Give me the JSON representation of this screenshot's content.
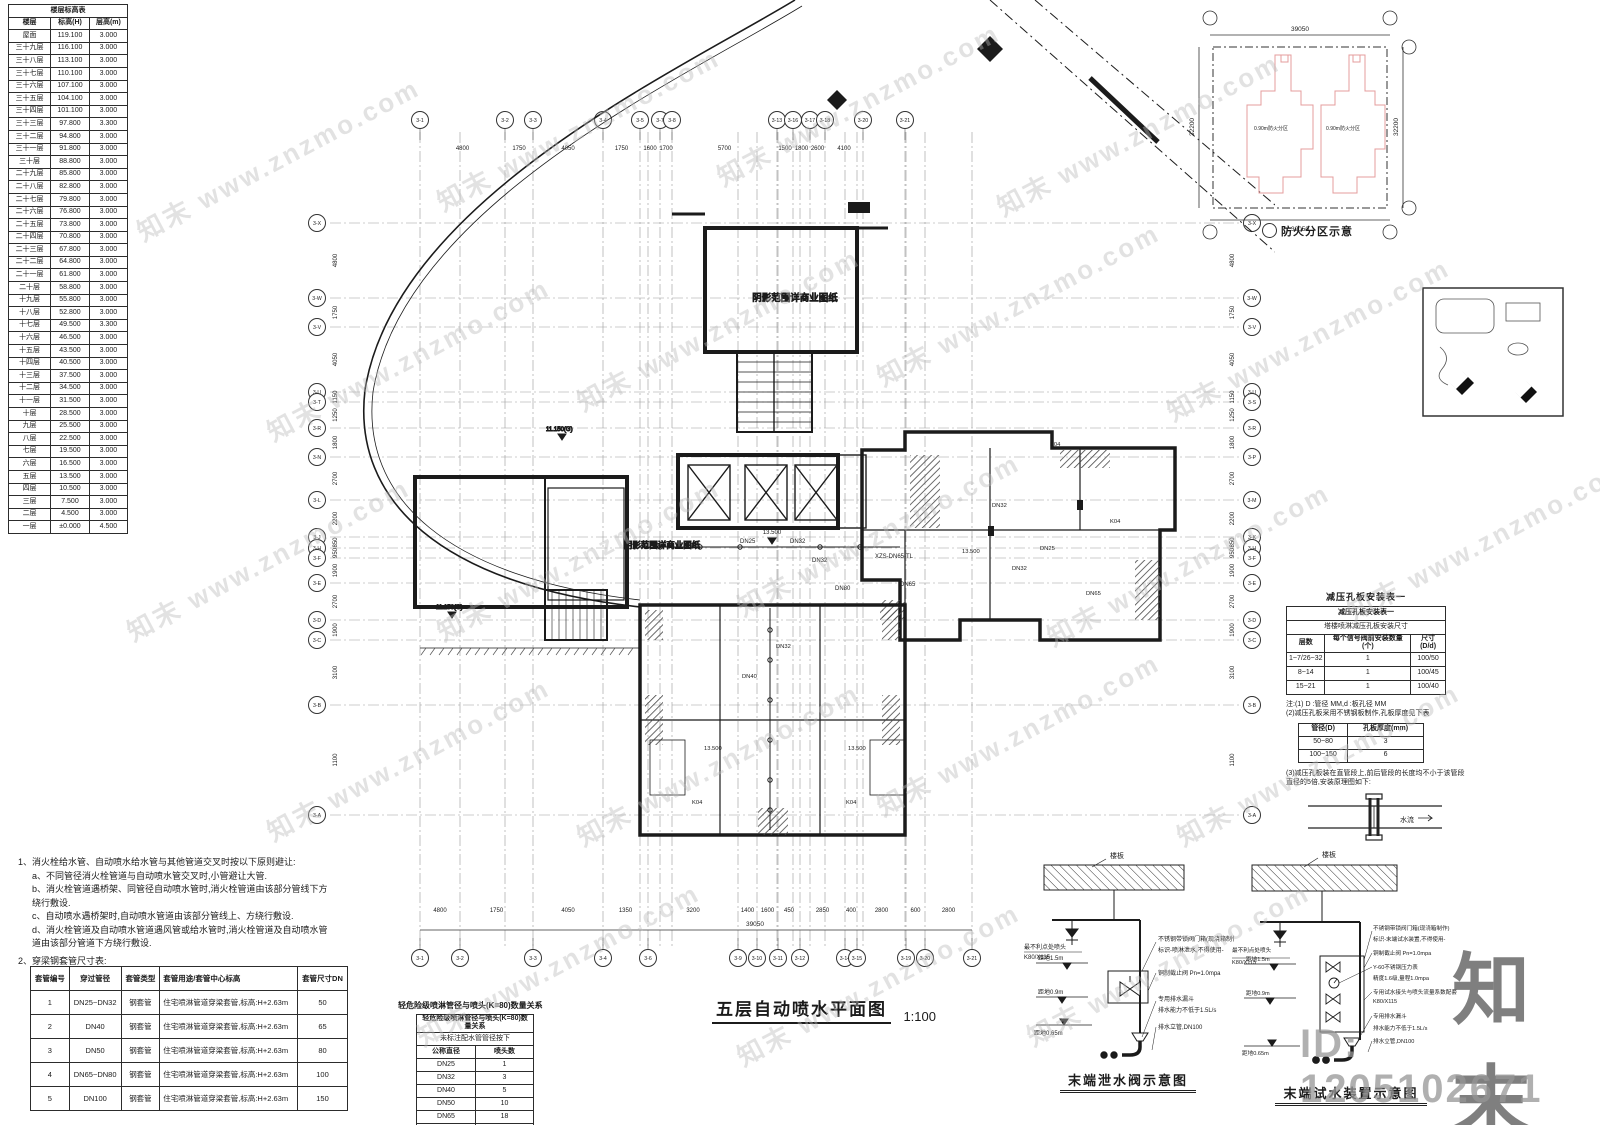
{
  "watermark": {
    "text": "知末 www.znzmo.com",
    "brand": "知末",
    "id_text": "ID: 1205102671"
  },
  "floor_table": {
    "title": "楼层标高表",
    "columns": [
      "楼层",
      "标高(H)",
      "层高(m)"
    ],
    "rows": [
      [
        "屋面",
        "119.100",
        "3.000"
      ],
      [
        "三十九层",
        "116.100",
        "3.000"
      ],
      [
        "三十八层",
        "113.100",
        "3.000"
      ],
      [
        "三十七层",
        "110.100",
        "3.000"
      ],
      [
        "三十六层",
        "107.100",
        "3.000"
      ],
      [
        "三十五层",
        "104.100",
        "3.000"
      ],
      [
        "三十四层",
        "101.100",
        "3.000"
      ],
      [
        "三十三层",
        "97.800",
        "3.300"
      ],
      [
        "三十二层",
        "94.800",
        "3.000"
      ],
      [
        "三十一层",
        "91.800",
        "3.000"
      ],
      [
        "三十层",
        "88.800",
        "3.000"
      ],
      [
        "二十九层",
        "85.800",
        "3.000"
      ],
      [
        "二十八层",
        "82.800",
        "3.000"
      ],
      [
        "二十七层",
        "79.800",
        "3.000"
      ],
      [
        "二十六层",
        "76.800",
        "3.000"
      ],
      [
        "二十五层",
        "73.800",
        "3.000"
      ],
      [
        "二十四层",
        "70.800",
        "3.000"
      ],
      [
        "二十三层",
        "67.800",
        "3.000"
      ],
      [
        "二十二层",
        "64.800",
        "3.000"
      ],
      [
        "二十一层",
        "61.800",
        "3.000"
      ],
      [
        "二十层",
        "58.800",
        "3.000"
      ],
      [
        "十九层",
        "55.800",
        "3.000"
      ],
      [
        "十八层",
        "52.800",
        "3.000"
      ],
      [
        "十七层",
        "49.500",
        "3.300"
      ],
      [
        "十六层",
        "46.500",
        "3.000"
      ],
      [
        "十五层",
        "43.500",
        "3.000"
      ],
      [
        "十四层",
        "40.500",
        "3.000"
      ],
      [
        "十三层",
        "37.500",
        "3.000"
      ],
      [
        "十二层",
        "34.500",
        "3.000"
      ],
      [
        "十一层",
        "31.500",
        "3.000"
      ],
      [
        "十层",
        "28.500",
        "3.000"
      ],
      [
        "九层",
        "25.500",
        "3.000"
      ],
      [
        "八层",
        "22.500",
        "3.000"
      ],
      [
        "七层",
        "19.500",
        "3.000"
      ],
      [
        "六层",
        "16.500",
        "3.000"
      ],
      [
        "五层",
        "13.500",
        "3.000"
      ],
      [
        "四层",
        "10.500",
        "3.000"
      ],
      [
        "三层",
        "7.500",
        "3.000"
      ],
      [
        "二层",
        "4.500",
        "3.000"
      ],
      [
        "一层",
        "±0.000",
        "4.500"
      ]
    ]
  },
  "notes": {
    "heading": "1、消火栓给水管、自动喷水给水管与其他管道交叉时按以下原则避让:",
    "items": [
      "a、不同管径消火栓管道与自动喷水管交叉时,小管避让大管.",
      "b、消火栓管道遇桥架、同管径自动喷水管时,消火栓管道由该部分管线下方绕行敷设.",
      "c、自动喷水遇桥架时,自动喷水管道由该部分管线上、方绕行敷设.",
      "d、消火栓管道及自动喷水管道遇风管或给水管时,消火栓管道及自动喷水管道由该部分管道下方绕行敷设."
    ],
    "table_heading": "2、穿梁钢套管尺寸表:"
  },
  "sleeve_table": {
    "columns": [
      "套管编号",
      "穿过管径",
      "套管类型",
      "套管用途/套管中心标高",
      "套管尺寸DN"
    ],
    "rows": [
      [
        "1",
        "DN25~DN32",
        "钢套管",
        "住宅喷淋管道穿梁套管,标高:H+2.63m",
        "50"
      ],
      [
        "2",
        "DN40",
        "钢套管",
        "住宅喷淋管道穿梁套管,标高:H+2.63m",
        "65"
      ],
      [
        "3",
        "DN50",
        "钢套管",
        "住宅喷淋管道穿梁套管,标高:H+2.63m",
        "80"
      ],
      [
        "4",
        "DN65~DN80",
        "钢套管",
        "住宅喷淋管道穿梁套管,标高:H+2.63m",
        "100"
      ],
      [
        "5",
        "DN100",
        "钢套管",
        "住宅喷淋管道穿梁套管,标高:H+2.63m",
        "150"
      ]
    ]
  },
  "head_table": {
    "title": "轻危险级喷淋管径与喷头(K=80)数量关系",
    "subtitle": "未标注配水管管径按下",
    "columns": [
      "公称直径",
      "喷头数"
    ],
    "rows": [
      [
        "DN25",
        "1"
      ],
      [
        "DN32",
        "3"
      ],
      [
        "DN40",
        "5"
      ],
      [
        "DN50",
        "10"
      ],
      [
        "DN65",
        "18"
      ],
      [
        "DN80",
        "48"
      ],
      [
        "DN100",
        "49个以上"
      ]
    ]
  },
  "orifice": {
    "title": "减压孔板安装表一",
    "subtitle": "塔楼喷淋减压孔板安装尺寸",
    "columns": [
      "层数",
      "每个信号阀前安装数量(个)",
      "尺寸(D/d)"
    ],
    "rows": [
      [
        "1~7/26~32",
        "1",
        "100/50"
      ],
      [
        "8~14",
        "1",
        "100/45"
      ],
      [
        "15~21",
        "1",
        "100/40"
      ]
    ],
    "note1": "注:(1) D :管径 MM,d :板孔径 MM",
    "note2": "(2)减压孔板采用不锈钢板制作,孔板厚度见下表",
    "thickness": {
      "columns": [
        "管径(D)",
        "孔板厚度(mm)"
      ],
      "rows": [
        [
          "50~80",
          "3"
        ],
        [
          "100~150",
          "6"
        ]
      ]
    },
    "note3": "(3)减压孔板装在直管段上,前后管段的长度均不小于该管段直径的5倍,安装原理图如下:",
    "flow_label": "水流"
  },
  "keyplan": {
    "caption": "防火分区示意",
    "dim_h": "39050",
    "dim_v": "32200",
    "unit_label": "0.90m防火分区"
  },
  "plan": {
    "title": "五层自动喷水平面图",
    "scale": "1:100",
    "shadow_label": "阴影范围详商业图纸",
    "total_dim": "39050",
    "pipe_labels": {
      "dn25": "DN25",
      "dn32": "DN32",
      "dn40": "DN40",
      "dn65": "DN65",
      "dn80": "DN80",
      "xzs": "XZS-DN65-TL"
    },
    "elev_labels": {
      "l13": "13.500",
      "l11": "11.150(G)"
    },
    "room_labels": {
      "k04": "K04"
    },
    "grid": {
      "top_labels": [
        "3-1",
        "3-2",
        "3-3",
        "3-4",
        "3-5",
        "3-7",
        "3-8",
        "3-13",
        "3-16",
        "3-17",
        "3-18",
        "3-20",
        "3-21"
      ],
      "top_dims": [
        "4800",
        "1750",
        "4050",
        "1750",
        "1600",
        "1700",
        "5700",
        "1500",
        "1800",
        "2600",
        "4100"
      ],
      "bottom_labels": [
        "3-1",
        "3-2",
        "3-3",
        "3-4",
        "3-6",
        "3-9",
        "3-10",
        "3-11",
        "3-12",
        "3-14",
        "3-15",
        "3-19",
        "3-20",
        "3-21"
      ],
      "bottom_dims": [
        "4800",
        "1750",
        "4050",
        "1350",
        "3200",
        "1400",
        "1600",
        "450",
        "2850",
        "400",
        "2800",
        "600",
        "2800"
      ],
      "left_labels": [
        "3-X",
        "3-W",
        "3-V",
        "3-U",
        "3-T",
        "3-R",
        "3-N",
        "3-L",
        "3-J",
        "3-H",
        "3-F",
        "3-E",
        "3-D",
        "3-C",
        "3-B",
        "3-A"
      ],
      "left_dims": [
        "4800",
        "1750",
        "4050",
        "1150",
        "1250",
        "1800",
        "2700",
        "2200",
        "850",
        "950",
        "1900",
        "2700",
        "1900",
        "3100",
        "1100"
      ],
      "right_labels": [
        "3-X",
        "3-W",
        "3-V",
        "3-U",
        "3-S",
        "3-R",
        "3-P",
        "3-M",
        "3-K",
        "3-H",
        "3-F",
        "3-E",
        "3-D",
        "3-C",
        "3-B",
        "3-A"
      ],
      "right_dims": [
        "4800",
        "1750",
        "4050",
        "1150",
        "1250",
        "1800",
        "2700",
        "2200",
        "850",
        "950",
        "1900",
        "2700",
        "1900",
        "3100",
        "1100"
      ]
    }
  },
  "details": [
    {
      "title": "末端泄水阀示意图",
      "slab_label": "楼板",
      "worst_head": "最不利点处喷头",
      "head_model": "K80/X115",
      "dist1": "距地1.5m",
      "dist2": "距地0.9m",
      "dist3": "距地0.65m",
      "ann": [
        "不锈钢带锁阀门箱(现浇箱制作)",
        "标识-喷淋泄水,不得使用-",
        "铜制截止阀 Pn=1.0mpa",
        "专用排水漏斗",
        "排水能力不低于1.5L/s",
        "排水立管,DN100"
      ]
    },
    {
      "title": "末端试水装置示意图",
      "slab_label": "楼板",
      "worst_head": "最不利点处喷头",
      "head_model": "K80/X115",
      "dist1": "距地1.5m",
      "dist2": "距地0.9m",
      "dist3": "距地0.65m",
      "ann": [
        "不锈钢带锁阀门箱(现浇箱制作)",
        "标识-末端试水装置,不得使用-",
        "铜制截止阀 Pn=1.0mpa",
        "Y-60不锈钢压力表",
        "精度1.6级,量程1.0mpa",
        "专用试水接头与喷头流量系数配套",
        "K80/X115",
        "专用排水漏斗",
        "排水能力不低于1.5L/s",
        "排水立管,DN100"
      ]
    }
  ]
}
